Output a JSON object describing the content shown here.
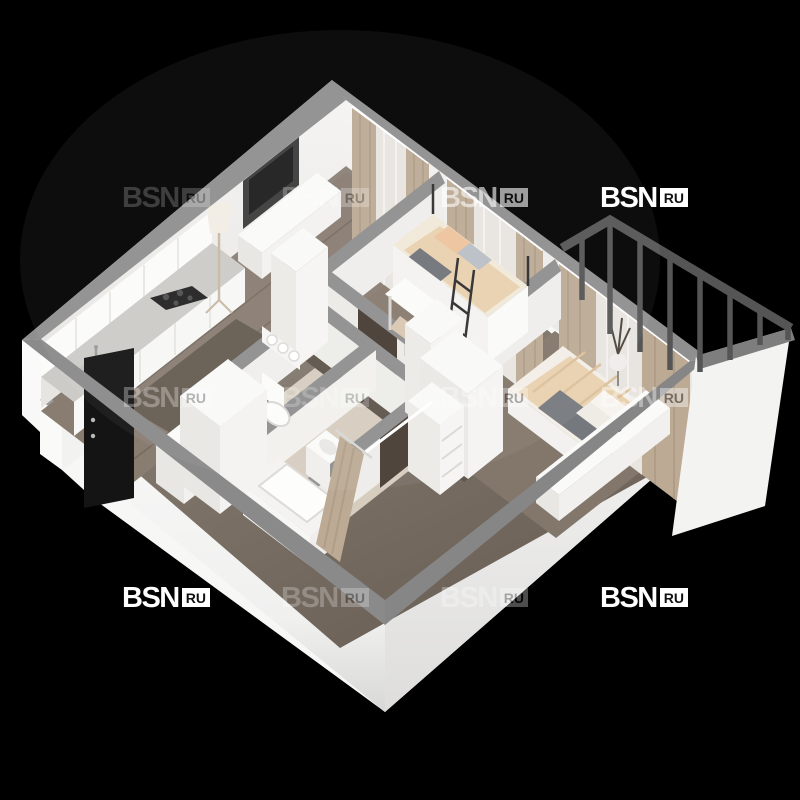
{
  "scene": {
    "description": "3D isometric render of a one-bedroom apartment floor plan on transparent background",
    "background": "#000000"
  },
  "watermark": {
    "brand": "BSN",
    "suffix": "RU",
    "positions": [
      {
        "x": 122,
        "y": 186,
        "opacity": 0.2
      },
      {
        "x": 281,
        "y": 186,
        "opacity": 0.25
      },
      {
        "x": 440,
        "y": 186,
        "opacity": 0.6
      },
      {
        "x": 600,
        "y": 186,
        "opacity": 1.0
      },
      {
        "x": 122,
        "y": 386,
        "opacity": 0.3
      },
      {
        "x": 281,
        "y": 386,
        "opacity": 0.22
      },
      {
        "x": 440,
        "y": 386,
        "opacity": 0.32
      },
      {
        "x": 600,
        "y": 386,
        "opacity": 0.4
      },
      {
        "x": 122,
        "y": 586,
        "opacity": 1.0
      },
      {
        "x": 281,
        "y": 586,
        "opacity": 0.25
      },
      {
        "x": 440,
        "y": 586,
        "opacity": 0.3
      },
      {
        "x": 600,
        "y": 586,
        "opacity": 1.0
      }
    ]
  },
  "palette": {
    "background": "#000000",
    "outer_wall": "#f7f7f6",
    "wall_top": "#8f8f8f",
    "inner_wall": "#f3f2f0",
    "floor_wood": "#80746a",
    "floor_dark": "#60564d",
    "tile": "#d6cdbf",
    "curtain": "#bcaa94",
    "sheer": "#eceae7",
    "furniture": "#f9f9f8",
    "tv_screen": "#1d1d1d",
    "door_interior": "#473c33",
    "door_entrance": "#141414",
    "balcony_frame": "#555555",
    "bedding": "#e9d1ae",
    "pillow_peach": "#eec39c",
    "blanket_gray": "#75797e"
  }
}
